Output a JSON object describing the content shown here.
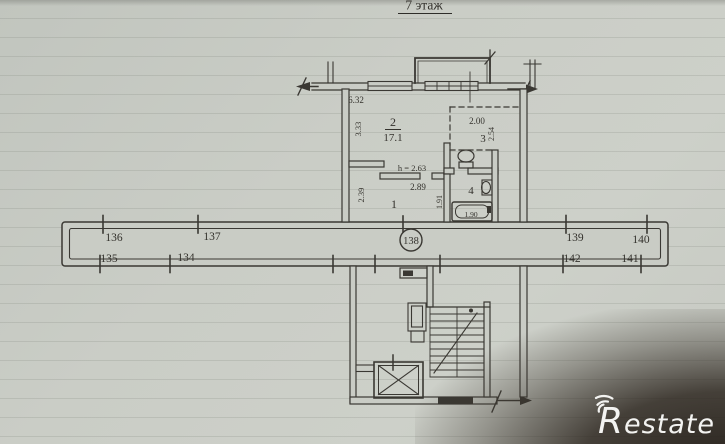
{
  "title": "7 этаж",
  "rooms": {
    "hall": "1",
    "living": "2",
    "living_area": "17.1",
    "kitchen": "3",
    "bath": "4"
  },
  "dims": {
    "top_width": "6.32",
    "room2_depth": "3.33",
    "room3_width": "2.00",
    "room3_depth": "2.54",
    "ceiling_height": "h = 2.63",
    "hall_width": "2.89",
    "hall_depth": "2.39",
    "bath_depth": "1.91",
    "bath_length": "1.90"
  },
  "corridor": {
    "circled_unit": "138",
    "top_row": [
      "136",
      "137",
      "139",
      "140"
    ],
    "bottom_row": [
      "135",
      "134",
      "142",
      "141"
    ]
  },
  "watermark": {
    "brand": "Restate"
  },
  "colors": {
    "ink": "#3a3833",
    "paper": "#c9ccc5",
    "logo": "#f3f3f1"
  }
}
